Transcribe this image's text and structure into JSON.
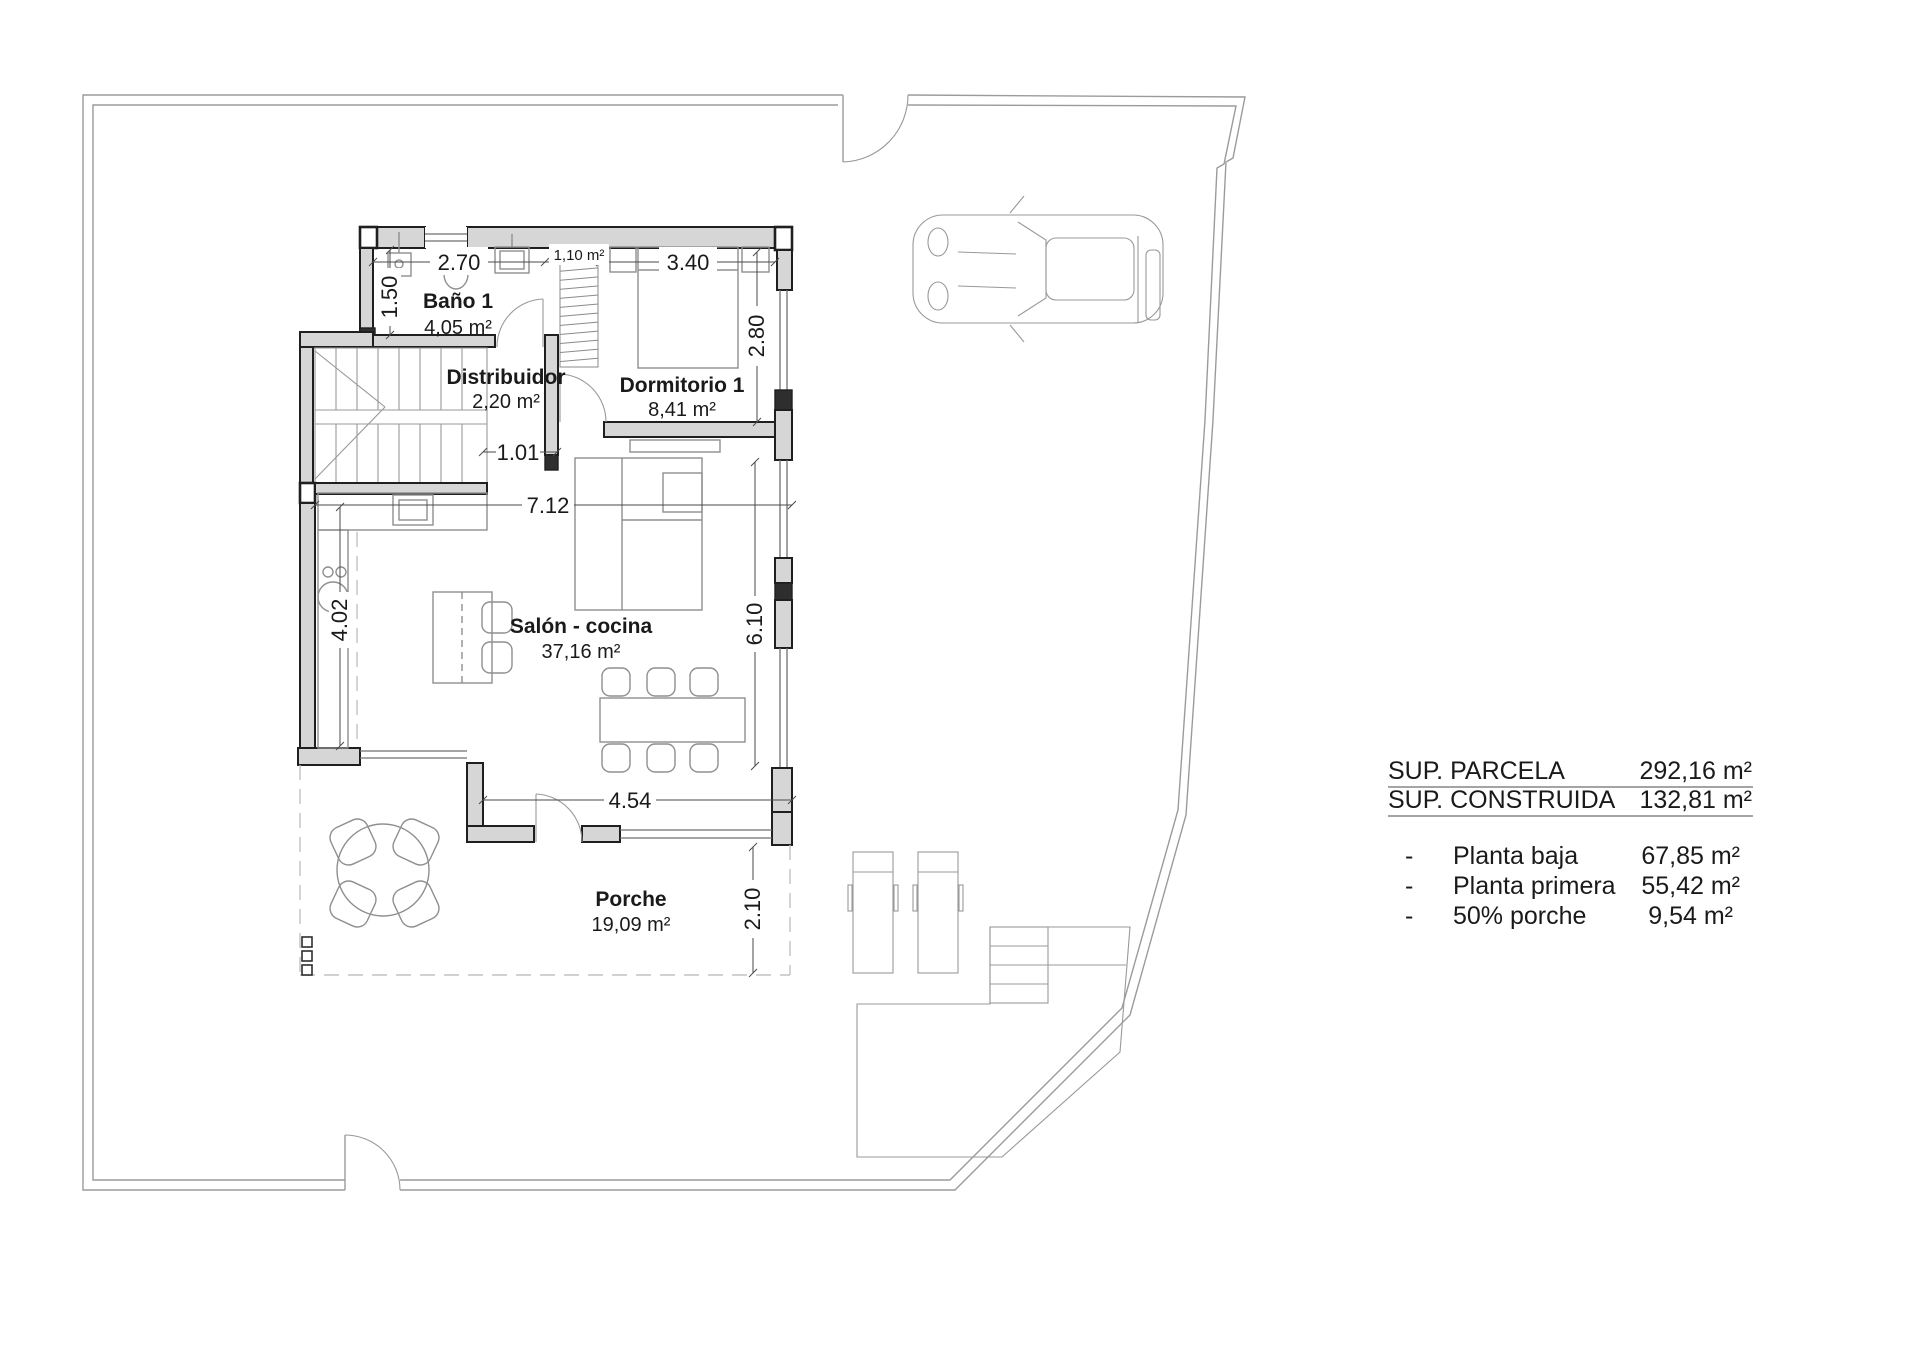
{
  "colors": {
    "wall_fill": "#d6d6d6",
    "wall_line": "#1f1f1f",
    "boundary": "#9b9b9b",
    "furniture": "#8f8f8f",
    "dashed": "#c2c2c2",
    "dim": "#4a4a4a",
    "text": "#1a1a1a"
  },
  "rooms": [
    {
      "name": "Baño 1",
      "area": "4,05 m²"
    },
    {
      "name": "Distribuidor",
      "area": "2,20 m²"
    },
    {
      "name": "Dormitorio 1",
      "area": "8,41 m²"
    },
    {
      "name": "Salón - cocina",
      "area": "37,16 m²"
    },
    {
      "name": "Porche",
      "area": "19,09 m²"
    }
  ],
  "closet": {
    "area": "1,10 m²"
  },
  "dimensions": {
    "bano_width": "2.70",
    "dorm_width": "3.40",
    "bano_depth": "1.50",
    "dorm_depth": "2.80",
    "hall_opening": "1.01",
    "salon_width": "7.12",
    "kitchen_depth": "4.02",
    "salon_depth": "6.10",
    "porch_width": "4.54",
    "porch_depth": "2.10"
  },
  "summary": {
    "totals": [
      {
        "label": "SUP. PARCELA",
        "value": "292,16 m²"
      },
      {
        "label": "SUP. CONSTRUIDA",
        "value": "132,81 m²"
      }
    ],
    "breakdown": [
      {
        "bullet": "-",
        "label": "Planta baja",
        "value": "67,85 m²"
      },
      {
        "bullet": "-",
        "label": "Planta primera",
        "value": "55,42 m²"
      },
      {
        "bullet": "-",
        "label": "50% porche",
        "value": "9,54 m²"
      }
    ]
  }
}
